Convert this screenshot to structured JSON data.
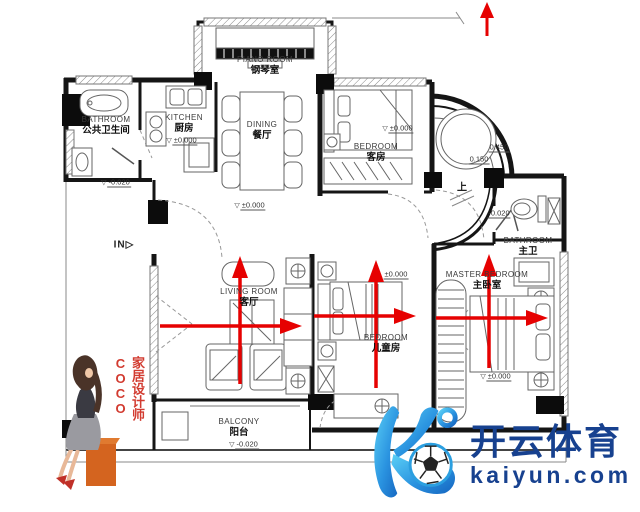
{
  "watermark": {
    "brand": "开云体育",
    "domain": "kaiyun.com",
    "logo": "kaiyun-k-soccer-ball-logo"
  },
  "designer_badge": {
    "text": "家居设计师COCO"
  },
  "markers": {
    "entry": "IN",
    "entry_arrow": "▷",
    "step_up": "上",
    "level_triangle": "▽"
  },
  "rooms": {
    "piano": {
      "en": "PIANO ROOM",
      "zh": "钢琴室"
    },
    "public_bath": {
      "en": "BATHROOM",
      "zh": "公共卫生间"
    },
    "kitchen": {
      "en": "KITCHEN",
      "zh": "厨房"
    },
    "dining": {
      "en": "DINING",
      "zh": "餐厅"
    },
    "guest": {
      "en": "BEDROOM",
      "zh": "客房"
    },
    "master_bath": {
      "en": "BATHROOM",
      "zh": "主卫"
    },
    "master": {
      "en": "MASTER BEDROOM",
      "zh": "主卧室"
    },
    "living": {
      "en": "LIVING ROOM",
      "zh": "客厅"
    },
    "kids": {
      "en": "BEDROOM",
      "zh": "儿童房"
    },
    "balcony": {
      "en": "BALCONY",
      "zh": "阳台"
    }
  },
  "levels": {
    "entry": "-0.020",
    "hall": "±0.000",
    "kitchen": "±0.000",
    "guest": "±0.000",
    "kids": "±0.000",
    "master": "±0.000",
    "balcony": "-0.020",
    "tub_rim": "0.450",
    "tub_step": "0.150",
    "master_bath_entry": "-0.020"
  },
  "flow_arrows": [
    {
      "room": "living",
      "directions": "up, right"
    },
    {
      "room": "kids",
      "directions": "up, right"
    },
    {
      "room": "master",
      "directions": "up, right"
    },
    {
      "room": "top-edge",
      "directions": "up"
    }
  ],
  "colors": {
    "arrow_red": "#e60101",
    "brand_blue": "#17418f",
    "logo_blue_light": "#5bd0f6",
    "logo_blue_dark": "#1565c0",
    "designer_red": "#d23b30",
    "stool_orange": "#d4641f"
  }
}
